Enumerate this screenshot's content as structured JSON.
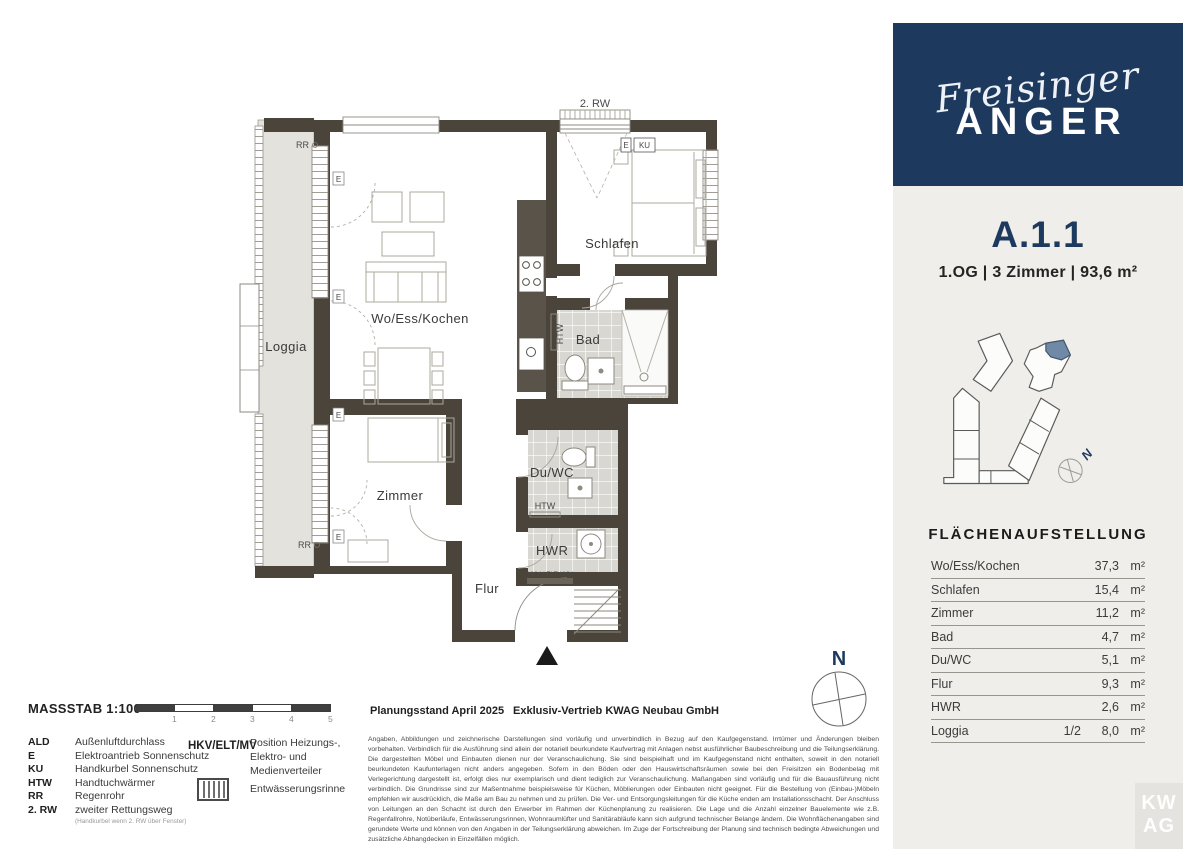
{
  "brand": {
    "script": "Freisinger",
    "caps": "ANGER"
  },
  "unit": {
    "id": "A.1.1",
    "meta": "1.OG  |  3 Zimmer  |  93,6 m²"
  },
  "area_table": {
    "title": "FLÄCHENAUFSTELLUNG",
    "unit": "m²",
    "rows": [
      {
        "label": "Wo/Ess/Kochen",
        "fraction": "",
        "value": "37,3"
      },
      {
        "label": "Schlafen",
        "fraction": "",
        "value": "15,4"
      },
      {
        "label": "Zimmer",
        "fraction": "",
        "value": "11,2"
      },
      {
        "label": "Bad",
        "fraction": "",
        "value": "4,7"
      },
      {
        "label": "Du/WC",
        "fraction": "",
        "value": "5,1"
      },
      {
        "label": "Flur",
        "fraction": "",
        "value": "9,3"
      },
      {
        "label": "HWR",
        "fraction": "",
        "value": "2,6"
      },
      {
        "label": "Loggia",
        "fraction": "1/2",
        "value": "8,0"
      }
    ]
  },
  "plan": {
    "rooms": {
      "wo_ess_kochen": "Wo/Ess/Kochen",
      "schlafen": "Schlafen",
      "zimmer": "Zimmer",
      "bad": "Bad",
      "du_wc": "Du/WC",
      "hwr": "HWR",
      "flur": "Flur",
      "loggia": "Loggia"
    },
    "marks": {
      "rw2": "2. RW",
      "e": "E",
      "ku": "KU",
      "rr": "RR",
      "htw": "HTW",
      "hkv": "HKV / ELT / MV"
    },
    "compass": "N"
  },
  "legend": {
    "scale_label": "MASSSTAB 1:100",
    "scale_ticks": [
      "1",
      "2",
      "3",
      "4",
      "5"
    ],
    "abbreviations": [
      {
        "key": "ALD",
        "desc": "Außenluftdurchlass"
      },
      {
        "key": "E",
        "desc": "Elektroantrieb Sonnenschutz"
      },
      {
        "key": "KU",
        "desc": "Handkurbel Sonnenschutz"
      },
      {
        "key": "HTW",
        "desc": "Handtuchwärmer"
      },
      {
        "key": "RR",
        "desc": "Regenrohr"
      },
      {
        "key": "2. RW",
        "desc": "zweiter Rettungsweg"
      }
    ],
    "rw_note": "(Handkurbel wenn 2. RW über Fenster)",
    "hkv_key": "HKV/ELT/MV",
    "hkv_desc": "Position Heizungs-, Elektro- und Medienverteiler",
    "drain_label": "Entwässerungsrinne"
  },
  "footer": {
    "planning": "Planungsstand April 2025",
    "sales": "Exklusiv-Vertrieb  KWAG Neubau GmbH",
    "disclaimer": "Angaben, Abbildungen und zeichnerische Darstellungen sind vorläufig und unverbindlich in Bezug auf den Kaufgegenstand. Irrtümer und Änderungen bleiben vorbehalten. Verbindlich für die Ausführung sind allein der notariell beurkundete Kaufvertrag mit Anlagen nebst ausführlicher Baubeschreibung und die Teilungserklärung. Die dargestellten Möbel und Einbauten dienen nur der Veranschaulichung. Sie sind beispielhaft und im Kaufgegenstand nicht enthalten, soweit in den notariell beurkundeten Kaufunterlagen nicht anders angegeben. Sofern in den Böden oder den Hauswirtschaftsräumen sowie bei den Freisitzen ein Bodenbelag mit Verlegerichtung dargestellt ist, erfolgt dies nur exemplarisch und dient lediglich zur Veranschaulichung. Maßangaben sind vorläufig und für die Bauausführung nicht verbindlich. Die Grundrisse sind zur Maßentnahme beispielsweise für Küchen, Möblierungen oder Einbauten nicht geeignet. Für die Bestellung von (Einbau-)Möbeln empfehlen wir ausdrücklich, die Maße am Bau zu nehmen und zu prüfen. Die Ver- und Entsorgungsleitungen für die Küche enden am Installationsschacht. Der Anschluss von Leitungen an den Schacht ist durch den Erwerber im Rahmen der Küchenplanung zu realisieren. Die Lage und die Anzahl einzelner Bauelemente wie z.B. Regenfallrohre, Notüberläufe, Entwässerungsrinnen, Wohnraumlüfter und Sanitärabläufe kann sich aufgrund technischer Belange ändern. Die Wohnflächenangaben sind gerundete Werte und können von den Angaben in der Teilungserklärung abweichen. Im Zuge der Fortschreibung der Planung sind technisch bedingte Abweichungen und zusätzliche Abhangdecken in Einzelfällen möglich."
  },
  "site": {
    "compass": "N"
  },
  "watermark": {
    "l1": "KW",
    "l2": "AG"
  },
  "colors": {
    "navy": "#1d3a5e",
    "wall": "#4a443a",
    "highlight": "#7089a6",
    "panel": "#efeeea"
  }
}
